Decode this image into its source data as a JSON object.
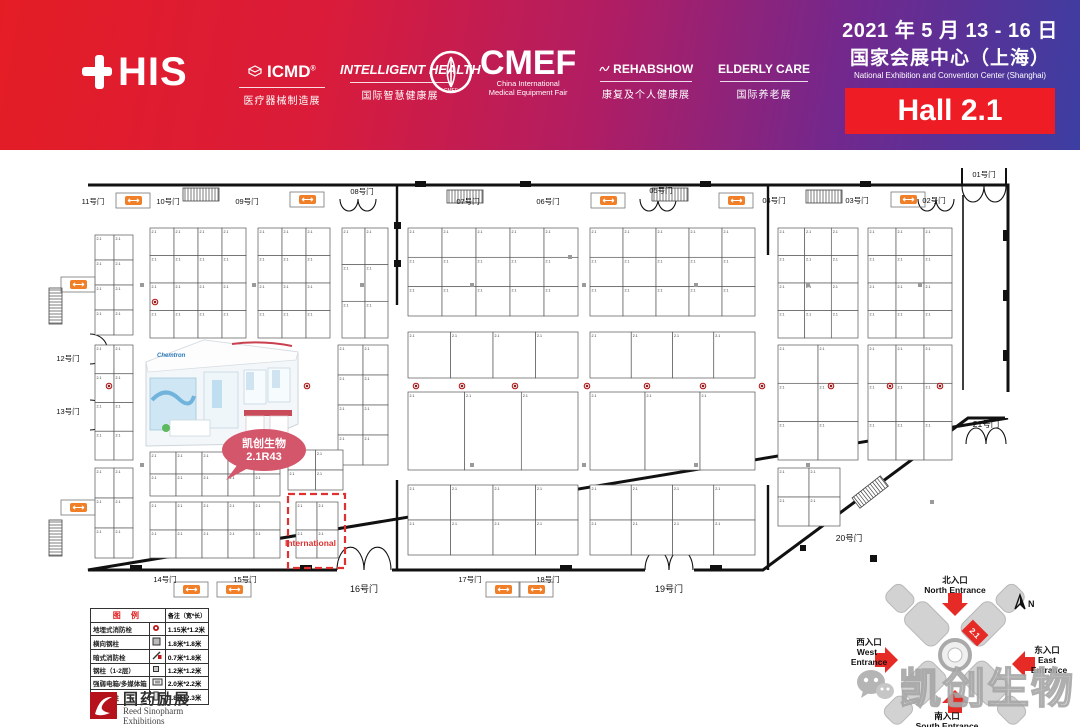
{
  "header": {
    "this_text": "HIS",
    "brands": [
      {
        "name": "ICMD",
        "tagline": "医疗器械制造展"
      },
      {
        "name": "INTELLIGENT HEALTH",
        "tagline": "国际智慧健康展"
      },
      {
        "name": "CMEF",
        "sub1": "China International",
        "sub2": "Medical Equipment Fair"
      },
      {
        "name": "REHABSHOW",
        "tagline": "康复及个人健康展"
      },
      {
        "name": "ELDERLY CARE",
        "tagline": "国际养老展"
      }
    ],
    "date_line": "2021 年 5 月 13 - 16 日",
    "venue_cn": "国家会展中心（上海）",
    "venue_en": "National Exhibition and Convention Center  (Shanghai)",
    "hall": "Hall 2.1"
  },
  "colors": {
    "hall_box": "#ee1c25",
    "escalator_orange": "#f07f28",
    "highlight_bubble": "#d4566b",
    "international_red": "#e03131"
  },
  "floorplan": {
    "booth_prefix": "2.1",
    "highlight": {
      "company": "凯创生物",
      "booth": "2.1R43",
      "render_logo": "Chemtron"
    },
    "international_label": "International",
    "gates": [
      {
        "label": "11号门",
        "x": 93,
        "y": 204,
        "s": 7.5
      },
      {
        "label": "10号门",
        "x": 168,
        "y": 204,
        "s": 7.5
      },
      {
        "label": "09号门",
        "x": 247,
        "y": 204,
        "s": 7.5
      },
      {
        "label": "08号门",
        "x": 362,
        "y": 194,
        "s": 7.5
      },
      {
        "label": "07号门",
        "x": 468,
        "y": 204,
        "s": 7.5
      },
      {
        "label": "06号门",
        "x": 548,
        "y": 204,
        "s": 7.5
      },
      {
        "label": "05号门",
        "x": 661,
        "y": 193,
        "s": 7.5
      },
      {
        "label": "04号门",
        "x": 774,
        "y": 203,
        "s": 7.5
      },
      {
        "label": "03号门",
        "x": 857,
        "y": 203,
        "s": 7.5
      },
      {
        "label": "02号门",
        "x": 934,
        "y": 203,
        "s": 7.5
      },
      {
        "label": "01号门",
        "x": 984,
        "y": 177,
        "s": 7.5
      },
      {
        "label": "12号门",
        "x": 68,
        "y": 361,
        "s": 7.5
      },
      {
        "label": "13号门",
        "x": 68,
        "y": 414,
        "s": 7.5
      },
      {
        "label": "14号门",
        "x": 165,
        "y": 582,
        "s": 7.5
      },
      {
        "label": "15号门",
        "x": 245,
        "y": 582,
        "s": 7.5
      },
      {
        "label": "16号门",
        "x": 364,
        "y": 592,
        "s": 9
      },
      {
        "label": "17号门",
        "x": 470,
        "y": 582,
        "s": 7.5
      },
      {
        "label": "18号门",
        "x": 548,
        "y": 582,
        "s": 7.5
      },
      {
        "label": "19号门",
        "x": 669,
        "y": 592,
        "s": 9
      },
      {
        "label": "20号门",
        "x": 849,
        "y": 541,
        "s": 8.5
      },
      {
        "label": "21号门",
        "x": 986,
        "y": 427,
        "s": 8.5
      }
    ],
    "booth_zones": [
      {
        "x": 95,
        "y": 235,
        "w": 38,
        "h": 100,
        "cols": 2,
        "rows": 4
      },
      {
        "x": 150,
        "y": 228,
        "w": 96,
        "h": 110,
        "cols": 4,
        "rows": 4
      },
      {
        "x": 258,
        "y": 228,
        "w": 72,
        "h": 110,
        "cols": 3,
        "rows": 4
      },
      {
        "x": 342,
        "y": 228,
        "w": 46,
        "h": 110,
        "cols": 2,
        "rows": 3
      },
      {
        "x": 95,
        "y": 345,
        "w": 38,
        "h": 115,
        "cols": 2,
        "rows": 4
      },
      {
        "x": 338,
        "y": 345,
        "w": 50,
        "h": 120,
        "cols": 2,
        "rows": 4
      },
      {
        "x": 95,
        "y": 468,
        "w": 38,
        "h": 90,
        "cols": 2,
        "rows": 3
      },
      {
        "x": 150,
        "y": 452,
        "w": 130,
        "h": 44,
        "cols": 5,
        "rows": 2
      },
      {
        "x": 150,
        "y": 502,
        "w": 130,
        "h": 56,
        "cols": 5,
        "rows": 2
      },
      {
        "x": 288,
        "y": 450,
        "w": 55,
        "h": 40,
        "cols": 2,
        "rows": 2
      },
      {
        "x": 296,
        "y": 502,
        "w": 42,
        "h": 56,
        "cols": 2,
        "rows": 2
      },
      {
        "x": 408,
        "y": 228,
        "w": 170,
        "h": 88,
        "cols": 5,
        "rows": 3
      },
      {
        "x": 590,
        "y": 228,
        "w": 165,
        "h": 88,
        "cols": 5,
        "rows": 3
      },
      {
        "x": 408,
        "y": 332,
        "w": 170,
        "h": 46,
        "cols": 4,
        "rows": 1
      },
      {
        "x": 590,
        "y": 332,
        "w": 165,
        "h": 46,
        "cols": 4,
        "rows": 1
      },
      {
        "x": 408,
        "y": 392,
        "w": 170,
        "h": 78,
        "cols": 3,
        "rows": 1
      },
      {
        "x": 590,
        "y": 392,
        "w": 165,
        "h": 78,
        "cols": 3,
        "rows": 1
      },
      {
        "x": 408,
        "y": 485,
        "w": 170,
        "h": 70,
        "cols": 4,
        "rows": 2
      },
      {
        "x": 590,
        "y": 485,
        "w": 165,
        "h": 70,
        "cols": 4,
        "rows": 2
      },
      {
        "x": 778,
        "y": 228,
        "w": 80,
        "h": 110,
        "cols": 3,
        "rows": 4
      },
      {
        "x": 868,
        "y": 228,
        "w": 84,
        "h": 110,
        "cols": 3,
        "rows": 4
      },
      {
        "x": 778,
        "y": 345,
        "w": 80,
        "h": 115,
        "cols": 2,
        "rows": 3
      },
      {
        "x": 868,
        "y": 345,
        "w": 84,
        "h": 115,
        "cols": 3,
        "rows": 3
      },
      {
        "x": 778,
        "y": 468,
        "w": 62,
        "h": 58,
        "cols": 2,
        "rows": 2
      }
    ],
    "hydrants": [
      [
        109,
        386
      ],
      [
        202,
        386
      ],
      [
        307,
        386
      ],
      [
        416,
        386
      ],
      [
        462,
        386
      ],
      [
        515,
        386
      ],
      [
        587,
        386
      ],
      [
        647,
        386
      ],
      [
        703,
        386
      ],
      [
        762,
        386
      ],
      [
        831,
        386
      ],
      [
        890,
        386
      ],
      [
        940,
        386
      ],
      [
        155,
        302
      ]
    ],
    "columns": [
      [
        140,
        283
      ],
      [
        252,
        283
      ],
      [
        360,
        283
      ],
      [
        470,
        283
      ],
      [
        582,
        283
      ],
      [
        694,
        283
      ],
      [
        806,
        283
      ],
      [
        918,
        283
      ],
      [
        140,
        463
      ],
      [
        252,
        463
      ],
      [
        470,
        463
      ],
      [
        582,
        463
      ],
      [
        694,
        463
      ],
      [
        806,
        463
      ],
      [
        568,
        255
      ],
      [
        930,
        500
      ]
    ],
    "escalators": [
      [
        125,
        196
      ],
      [
        299,
        195
      ],
      [
        600,
        196
      ],
      [
        728,
        196
      ],
      [
        900,
        195
      ],
      [
        70,
        280
      ],
      [
        70,
        503
      ],
      [
        183,
        585
      ],
      [
        226,
        585
      ],
      [
        495,
        585
      ],
      [
        528,
        585
      ]
    ],
    "stairs": [
      [
        183,
        188,
        0
      ],
      [
        447,
        190,
        0
      ],
      [
        652,
        188,
        0
      ],
      [
        806,
        190,
        0
      ],
      [
        62,
        288,
        90
      ],
      [
        62,
        520,
        90
      ],
      [
        852,
        498,
        -38
      ]
    ]
  },
  "legend": {
    "title": "图 例",
    "note_header": "备注（宽*长）",
    "rows": [
      {
        "label": "地埋式消防栓",
        "size": "1.15米*1.2米"
      },
      {
        "label": "横向钢柱",
        "size": "1.8米*1.8米"
      },
      {
        "label": "暗式消防栓",
        "size": "0.7米*1.8米"
      },
      {
        "label": "钢柱（1-2层）",
        "size": "1.2米*1.2米"
      },
      {
        "label": "强弱电箱/多媒体箱",
        "size": "2.0米*2.2米"
      },
      {
        "label": "电讯钢柱",
        "size": "1.8米*2.3米"
      }
    ]
  },
  "organizer": {
    "name_cn": "国药励展",
    "name_en1": "Reed Sinopharm",
    "name_en2": "Exhibitions"
  },
  "minimap": {
    "hall_marker": "2.1",
    "compass": "N",
    "entrances": {
      "north_cn": "北入口",
      "north_en": "North Entrance",
      "west_cn": "西入口",
      "west_en1": "West",
      "west_en2": "Entrance",
      "east_cn": "东入口",
      "east_en1": "East",
      "east_en2": "Entrance",
      "south_cn": "南入口",
      "south_en": "South Entrance"
    }
  },
  "watermark": {
    "text": "凯创生物"
  }
}
